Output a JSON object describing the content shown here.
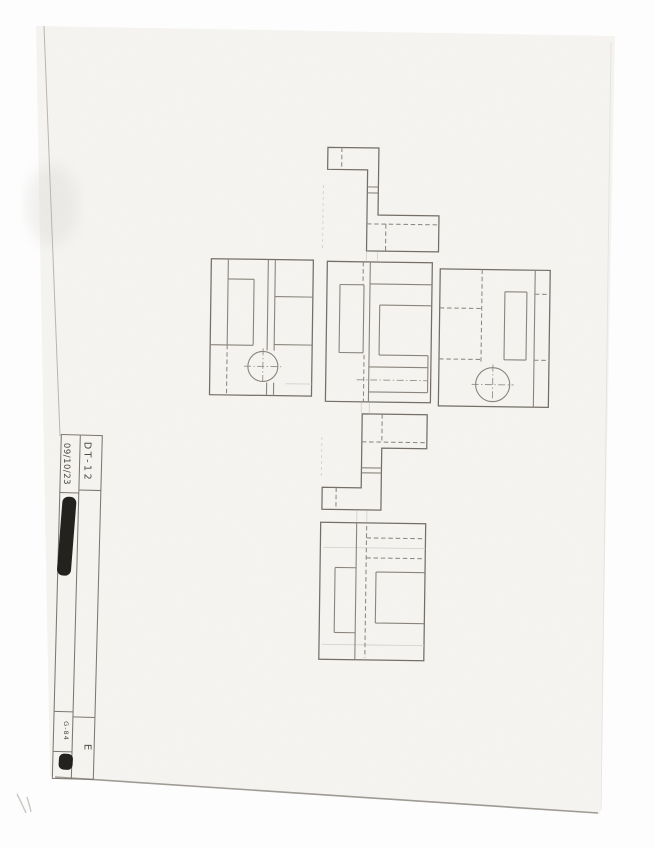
{
  "title_block": {
    "drawing_code": "DT-12",
    "date": "09/10/23",
    "revision_letter": "E",
    "sheet_code": "G-84",
    "redaction_count": 2
  },
  "scene": {
    "background_color": "#fdfdfd",
    "paper_color": "#f5f4f1",
    "pencil_color": "#8a847c",
    "outline_color": "#746e67",
    "handwriting_color": "#4e4943",
    "redaction_color": "#1b1916",
    "paper_quad": [
      [
        36,
        26
      ],
      [
        615,
        36
      ],
      [
        600,
        814
      ],
      [
        50,
        776
      ]
    ],
    "edges": [
      {
        "x1": 44,
        "y1": 26,
        "x2": 60,
        "y2": 436,
        "c": "#b3afa8",
        "w": 1,
        "o": 0.9
      },
      {
        "x1": 55,
        "y1": 777,
        "x2": 598,
        "y2": 813,
        "c": "#8f8b84",
        "w": 1.6,
        "o": 0.85
      },
      {
        "x1": 611,
        "y1": 42,
        "x2": 601,
        "y2": 810,
        "c": "#e4e2de",
        "w": 1,
        "o": 0.9
      }
    ],
    "stray_marks": [
      "M17,794 C20,800 23,806 26,813",
      "M27,797 C28.5,802 30,807 31,812"
    ]
  },
  "title_block_geometry": {
    "rotate": "rotate(1.5 78 600)",
    "outer": [
      57,
      435,
      98,
      779
    ],
    "divider_x": 76,
    "left_rows_y": [
      493,
      712,
      752
    ],
    "right_rows_y": [
      490,
      717
    ],
    "redactions": [
      {
        "x": 58,
        "y": 497,
        "w": 14,
        "h": 79,
        "rx": 6,
        "rot": 3
      },
      {
        "x": 63,
        "y": 754,
        "w": 14,
        "h": 16,
        "rx": 5,
        "rot": 2
      }
    ]
  },
  "views": {
    "rotate": "rotate(0.8 375 430)",
    "projection_faint": [
      [
        364,
        252,
        364,
        261
      ],
      [
        375,
        252,
        375,
        261
      ],
      [
        361,
        403,
        361,
        413
      ],
      [
        369,
        403,
        369,
        413
      ],
      [
        358,
        511,
        358,
        522
      ],
      [
        368,
        511,
        368,
        522
      ]
    ],
    "projection_faint_dashed": [
      [
        320,
        186,
        320,
        252
      ],
      [
        322,
        438,
        322,
        478
      ]
    ],
    "list": [
      {
        "name": "top-view",
        "outline": [
          [
            324,
            148
          ],
          [
            375,
            148
          ],
          [
            375,
            215
          ],
          [
            436,
            215
          ],
          [
            436,
            251
          ],
          [
            364,
            251
          ],
          [
            364,
            170
          ],
          [
            324,
            170
          ]
        ],
        "solid": [
          [
            364,
            187,
            375,
            187
          ],
          [
            364,
            193,
            375,
            193
          ]
        ],
        "hidden": [
          [
            338,
            148,
            338,
            170
          ],
          [
            364,
            224,
            436,
            224
          ],
          [
            383,
            224,
            383,
            251
          ]
        ],
        "center": [],
        "faint": [],
        "circles": []
      },
      {
        "name": "left-side-view",
        "rect": [
          209,
          261,
          311,
          397
        ],
        "solid": [
          [
            226,
            261,
            226,
            347
          ],
          [
            209,
            347,
            252,
            347
          ],
          [
            226,
            281,
            252,
            281
          ],
          [
            252,
            281,
            252,
            347
          ],
          [
            266,
            261,
            266,
            352
          ],
          [
            273,
            261,
            273,
            352
          ],
          [
            266,
            384,
            266,
            397
          ],
          [
            273,
            384,
            273,
            397
          ],
          [
            273,
            298,
            311,
            298
          ],
          [
            273,
            346,
            311,
            346
          ]
        ],
        "hidden": [
          [
            226,
            347,
            226,
            397
          ]
        ],
        "center": [
          [
            243,
            368,
            283,
            368
          ],
          [
            262,
            350,
            262,
            386
          ]
        ],
        "faint": [
          [
            285,
            385,
            311,
            385
          ]
        ],
        "circles": [
          {
            "cx": 262,
            "cy": 368,
            "r": 15
          }
        ]
      },
      {
        "name": "front-view",
        "rect": [
          325,
          262,
          430,
          402
        ],
        "solid": [
          [
            338,
            285,
            362,
            285
          ],
          [
            338,
            285,
            338,
            353
          ],
          [
            338,
            353,
            362,
            353
          ],
          [
            362,
            285,
            362,
            353
          ],
          [
            368,
            262,
            368,
            402
          ],
          [
            368,
            284,
            430,
            284
          ],
          [
            378,
            305,
            378,
            355
          ],
          [
            378,
            305,
            430,
            305
          ],
          [
            378,
            355,
            427,
            355
          ],
          [
            427,
            355,
            427,
            392
          ],
          [
            368,
            367,
            427,
            367
          ],
          [
            368,
            392,
            427,
            392
          ]
        ],
        "hidden": [
          [
            361,
            262,
            361,
            285
          ],
          [
            363,
            355,
            363,
            402
          ]
        ],
        "center": [
          [
            356,
            380,
            427,
            380
          ]
        ],
        "faint": [],
        "circles": []
      },
      {
        "name": "right-side-view",
        "rect": [
          438,
          268,
          548,
          405
        ],
        "solid": [
          [
            503,
            290,
            525,
            290
          ],
          [
            503,
            290,
            503,
            358
          ],
          [
            525,
            290,
            525,
            358
          ],
          [
            503,
            358,
            525,
            358
          ],
          [
            533,
            268,
            533,
            405
          ]
        ],
        "hidden": [
          [
            480,
            268,
            480,
            363
          ],
          [
            438,
            307,
            480,
            307
          ],
          [
            438,
            358,
            480,
            358
          ],
          [
            533,
            292,
            548,
            292
          ],
          [
            533,
            358,
            548,
            358
          ]
        ],
        "center": [
          [
            471,
            383,
            513,
            383
          ],
          [
            492,
            363,
            492,
            403
          ]
        ],
        "faint": [],
        "circles": [
          {
            "cx": 492,
            "cy": 383,
            "r": 17
          }
        ]
      },
      {
        "name": "bottom-view",
        "outline": [
          [
            362,
            414
          ],
          [
            427,
            414
          ],
          [
            427,
            448
          ],
          [
            382,
            448
          ],
          [
            382,
            510
          ],
          [
            323,
            510
          ],
          [
            323,
            488
          ],
          [
            362,
            488
          ]
        ],
        "solid": [
          [
            362,
            468,
            382,
            468
          ],
          [
            362,
            473,
            382,
            473
          ]
        ],
        "hidden": [
          [
            362,
            442,
            427,
            442
          ],
          [
            382,
            414,
            382,
            442
          ],
          [
            337,
            488,
            337,
            510
          ]
        ],
        "center": [],
        "faint": [],
        "circles": []
      },
      {
        "name": "rear-view",
        "rect": [
          322,
          523,
          427,
          660
        ],
        "solid": [
          [
            358,
            523,
            358,
            660
          ],
          [
            378,
            572,
            378,
            623
          ],
          [
            378,
            572,
            427,
            572
          ],
          [
            378,
            623,
            427,
            623
          ],
          [
            337,
            568,
            358,
            568
          ],
          [
            337,
            568,
            337,
            633
          ],
          [
            337,
            633,
            358,
            633
          ]
        ],
        "hidden": [
          [
            368,
            526,
            368,
            658
          ],
          [
            368,
            538,
            427,
            538
          ],
          [
            368,
            558,
            427,
            558
          ]
        ],
        "center": [],
        "faint": [
          [
            325,
            548,
            427,
            548
          ],
          [
            325,
            645,
            427,
            645
          ]
        ],
        "circles": []
      }
    ]
  }
}
